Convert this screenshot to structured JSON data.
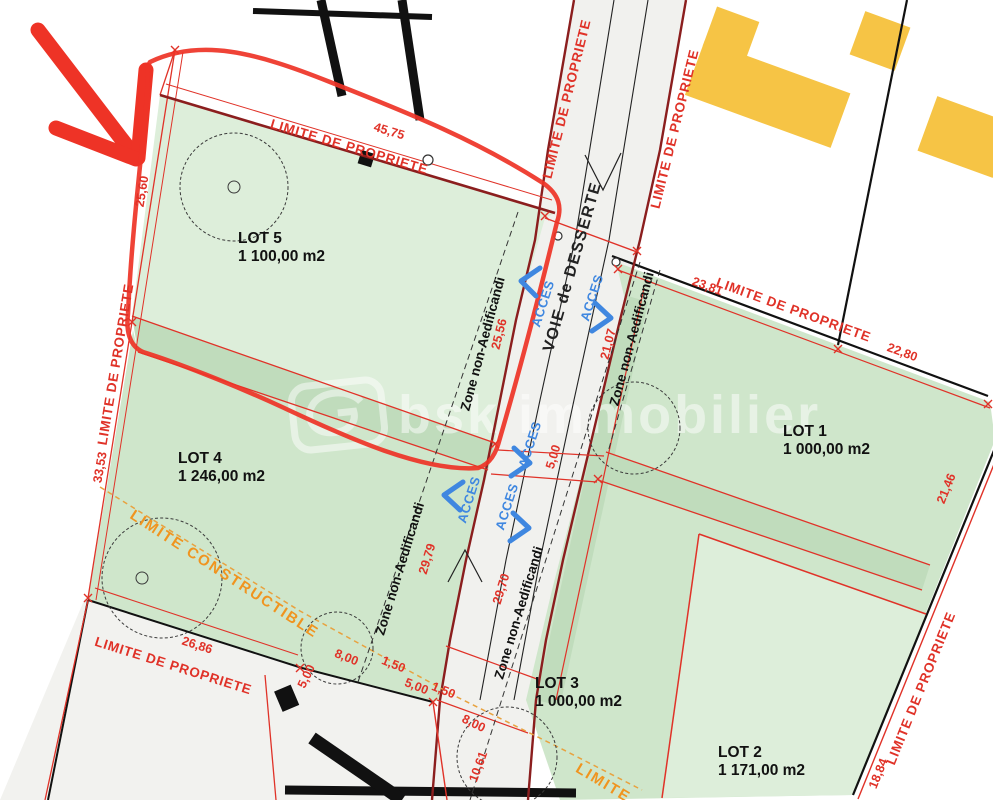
{
  "plan": {
    "watermark_brand": "bsk immobilier",
    "road_label": "VOIE de DESSERTE",
    "access_label": "ACCES",
    "property_limit_label": "LIMITE DE PROPRIETE",
    "zone_label": "Zone non-Aedificandi",
    "constructible_label": "LIMITE CONSTRUCTIBLE",
    "constructible_label_short": "LIMITE",
    "lots": {
      "lot1": {
        "name": "LOT 1",
        "area": "1 000,00 m2"
      },
      "lot2": {
        "name": "LOT 2",
        "area": "1 171,00 m2"
      },
      "lot3": {
        "name": "LOT 3",
        "area": "1 000,00 m2"
      },
      "lot4": {
        "name": "LOT 4",
        "area": "1 246,00 m2"
      },
      "lot5": {
        "name": "LOT 5",
        "area": "1 100,00 m2"
      }
    },
    "dimensions": {
      "lot5_top": "45,75",
      "left_upper": "25,60",
      "left_lower": "33,53",
      "bottom_left": "26,86",
      "road_left": "25,56",
      "lot1_west": "21,07",
      "lot1_top_a": "23,81",
      "lot1_top_b": "22,80",
      "right_upper": "21,46",
      "right_lower": "18,84",
      "zone_left": "29,79",
      "zone_right": "29,70",
      "five": "5,00",
      "one_fifty": "1,50",
      "eight": "8,00",
      "ten_sixtyone": "10,61"
    },
    "colors": {
      "dimension_red": "#e03228",
      "boundary_maroon": "#8b1e1e",
      "annotation_red": "#ee3326",
      "constructible_orange": "#f0941f",
      "access_blue": "#3f87e0",
      "building_yellow": "#f6c445",
      "lot_green_light": "#ddeeda",
      "lot_green_medium": "#cfe6cb",
      "lot_green_dark": "#c0dcbc",
      "road_grey": "#f1f1ee"
    }
  }
}
